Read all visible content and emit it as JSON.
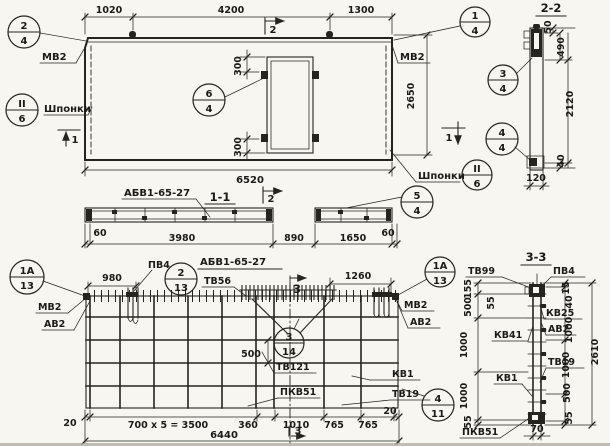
{
  "elevation": {
    "dims": {
      "left": "1020",
      "middle": "4200",
      "right": "1300",
      "width": "6520",
      "height": "2650",
      "door_top": "300",
      "door_bottom": "300"
    },
    "labels": {
      "mv2_left": "МВ2",
      "mv2_right": "МВ2",
      "shponki_left": "Шпонки",
      "shponki_right": "Шпонки"
    },
    "callouts": {
      "c24": {
        "top": "2",
        "bottom": "4"
      },
      "c14": {
        "top": "1",
        "bottom": "4"
      },
      "c64": {
        "top": "6",
        "bottom": "4"
      },
      "c26_left": {
        "top": "II",
        "bottom": "6"
      },
      "c26_right": {
        "top": "II",
        "bottom": "6"
      },
      "c54": {
        "top": "5",
        "bottom": "4"
      }
    },
    "markers": {
      "cut1": "1",
      "cut2": "2"
    }
  },
  "section_1_1": {
    "title": "1-1",
    "beam_label": "АБВ1-65-27",
    "dims": {
      "d1": "60",
      "d2": "3980",
      "d3": "890",
      "d4": "1650",
      "d5": "60"
    }
  },
  "section_2_2": {
    "title": "2-2",
    "dims": {
      "d50": "50",
      "d490": "490",
      "d2120": "2120",
      "d40": "40",
      "width": "120"
    },
    "callouts": {
      "c34": {
        "top": "3",
        "bottom": "4"
      },
      "c44": {
        "top": "4",
        "bottom": "4"
      }
    }
  },
  "plan": {
    "title": "АБВ1-65-27",
    "dims": {
      "top_left": "980",
      "top_right": "1260",
      "mid": "500",
      "bottom": [
        "20",
        "700 x 5 = 3500",
        "360",
        "1010",
        "765",
        "765",
        "20"
      ],
      "total": "6440"
    },
    "labels": {
      "pv4": "ПВ4",
      "tv56": "ТВ56",
      "mv2_left": "МВ2",
      "av2_left": "АВ2",
      "mv2_right": "МВ2",
      "av2_right": "АВ2",
      "tv121": "ТВ121",
      "kv1": "КВ1",
      "pkv51": "ПКВ51",
      "tv19": "ТВ19"
    },
    "callouts": {
      "c1a13_left": {
        "top": "1А",
        "bottom": "13"
      },
      "c213": {
        "top": "2",
        "bottom": "13"
      },
      "c1a13_right": {
        "top": "1А",
        "bottom": "13"
      },
      "c314": {
        "top": "3",
        "bottom": "14"
      },
      "c411": {
        "top": "4",
        "bottom": "11"
      }
    },
    "markers": {
      "cut3": "3"
    }
  },
  "section_3_3": {
    "title": "3-3",
    "labels": {
      "tv99": "ТВ99",
      "pv4": "ПВ4",
      "kv25": "КВ25",
      "av2": "АВ2",
      "kv41": "КВ41",
      "tv19": "ТВ19",
      "kv1": "КВ1",
      "pkv51": "ПКВ51"
    },
    "dims": {
      "left": [
        "155",
        "500",
        "1000",
        "1000",
        "55"
      ],
      "inner_55": "55",
      "right": [
        "15",
        "40",
        "1000",
        "1000",
        "500",
        "55"
      ],
      "total": "2610",
      "bottom": "70"
    }
  }
}
